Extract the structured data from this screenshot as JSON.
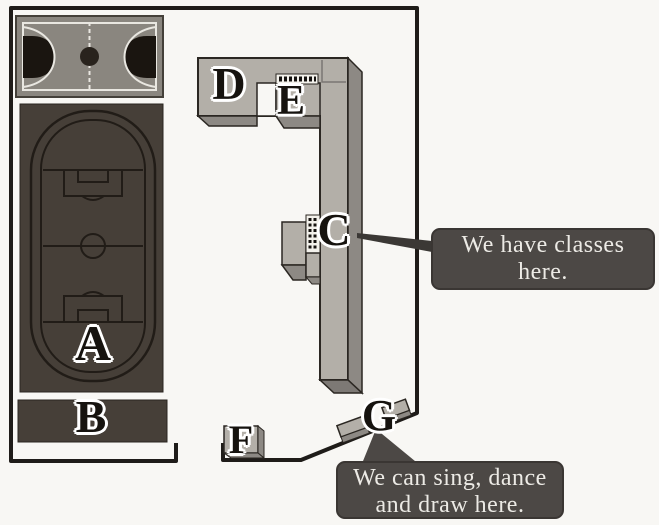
{
  "scene": {
    "description": "school campus plan with labeled places and two speech callouts"
  },
  "labels": {
    "a": "A",
    "b": "B",
    "c": "C",
    "d": "D",
    "e": "E",
    "f": "F",
    "g": "G"
  },
  "callouts": {
    "classes": {
      "line1": "We have classes",
      "line2": "here."
    },
    "art": {
      "line1": "We can sing, dance",
      "line2": "and draw here."
    }
  },
  "colors": {
    "wall": "#1f1c19",
    "outline": "#2b2722",
    "court_gray": "#8a867f",
    "court_line": "#e9e7e1",
    "key_black": "#1a1510",
    "field_dark": "#463f38",
    "pitch_line": "#211c17",
    "building_top": "#b3afa8",
    "building_side": "#8d8984",
    "building_bevel": "#7d7975",
    "steps_bg": "#f3f1eb",
    "connector": "#3b3835",
    "bubble_bg": "#4c4845",
    "bubble_text": "#eceae5"
  }
}
